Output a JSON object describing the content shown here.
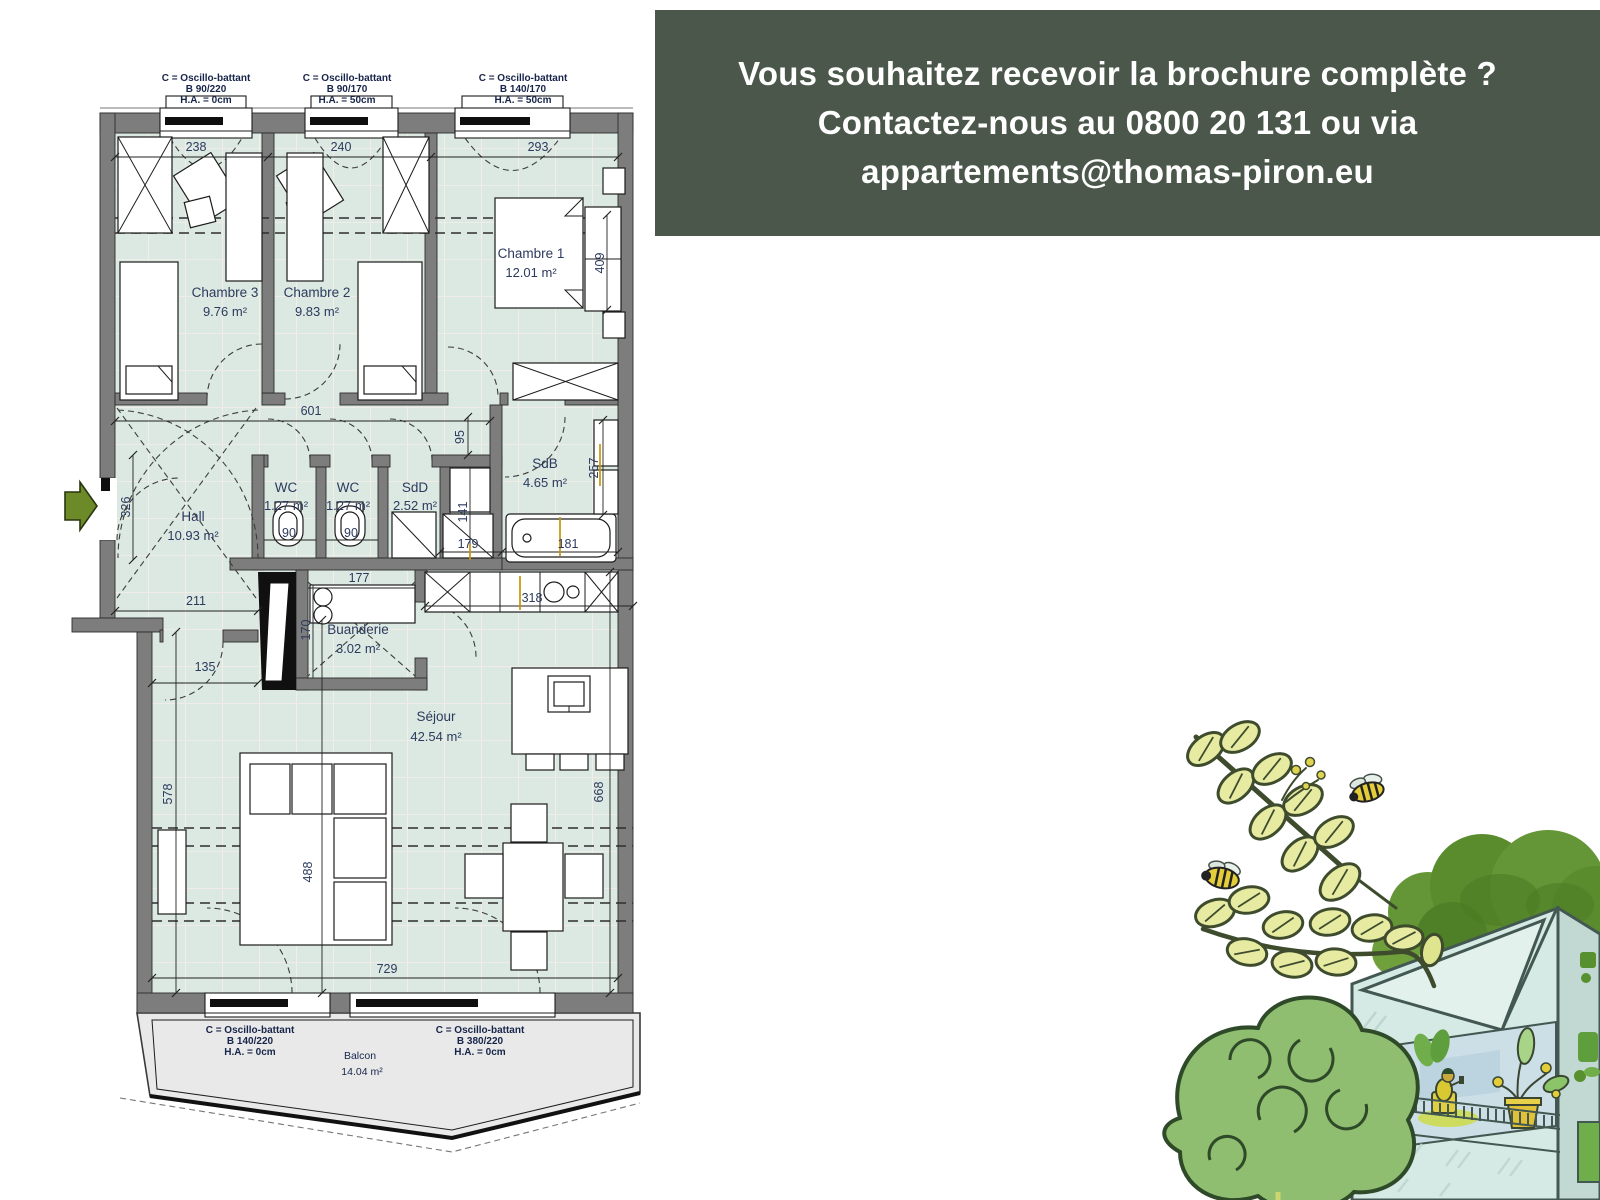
{
  "banner": {
    "background": "#4a574a",
    "text_color": "#ffffff",
    "line1": "Vous souhaitez recevoir la brochure complète ?",
    "line2": "Contactez-nous au 0800 20 131 ou via",
    "line3": "appartements@thomas-piron.eu"
  },
  "plan": {
    "colors": {
      "floor": "#dce9e2",
      "wall": "#7d7d7d",
      "balcony": "#e9e9e9",
      "label_text": "#2c3a5e",
      "entrance_arrow": "#6d8a28",
      "tick_accent": "#c8940a"
    },
    "rooms": {
      "chambre1": {
        "name": "Chambre 1",
        "area": "12.01 m²"
      },
      "chambre2": {
        "name": "Chambre 2",
        "area": "9.83 m²"
      },
      "chambre3": {
        "name": "Chambre 3",
        "area": "9.76 m²"
      },
      "hall": {
        "name": "Hall",
        "area": "10.93 m²"
      },
      "wc1": {
        "name": "WC",
        "area": "1.27 m²"
      },
      "wc2": {
        "name": "WC",
        "area": "1.27 m²"
      },
      "sdd": {
        "name": "SdD",
        "area": "2.52 m²"
      },
      "sdb": {
        "name": "SdB",
        "area": "4.65 m²"
      },
      "buanderie": {
        "name": "Buanderie",
        "area": "3.02 m²"
      },
      "sejour": {
        "name": "Séjour",
        "area": "42.54 m²"
      },
      "balcon": {
        "name": "Balcon",
        "area": "14.04 m²"
      }
    },
    "window_labels": {
      "top1": {
        "l1": "C = Oscillo-battant",
        "l2": "B 90/220",
        "l3": "H.A. = 0cm"
      },
      "top2": {
        "l1": "C = Oscillo-battant",
        "l2": "B 90/170",
        "l3": "H.A. = 50cm"
      },
      "top3": {
        "l1": "C = Oscillo-battant",
        "l2": "B 140/170",
        "l3": "H.A. = 50cm"
      },
      "bottom1": {
        "l1": "C = Oscillo-battant",
        "l2": "B 140/220",
        "l3": "H.A. = 0cm"
      },
      "bottom2": {
        "l1": "C = Oscillo-battant",
        "l2": "B 380/220",
        "l3": "H.A. = 0cm"
      }
    },
    "dimensions": {
      "chambre3_width": "238",
      "chambre2_width": "240",
      "chambre1_width": "293",
      "chambre1_depth": "409",
      "corridor_length": "601",
      "corridor_width": "95",
      "sdb_right_depth": "257",
      "hall_entry_height": "326",
      "wc1_width": "90",
      "wc2_width": "90",
      "cabinet_depth": "141",
      "cabinet_width": "179",
      "bath_width": "181",
      "hall_bottom_width": "211",
      "buanderie_counter": "177",
      "kitchen_width": "318",
      "buanderie_depth": "170",
      "hall_door_width": "135",
      "sejour_left_depth": "578",
      "sejour_mid_depth": "488",
      "sejour_right_depth": "668",
      "sejour_width": "729"
    }
  },
  "illustration": {
    "elements": [
      "leaf-sprig",
      "bees",
      "round-tree",
      "apartment-building",
      "balcony-person",
      "potted-plant",
      "roof-hedge"
    ]
  }
}
